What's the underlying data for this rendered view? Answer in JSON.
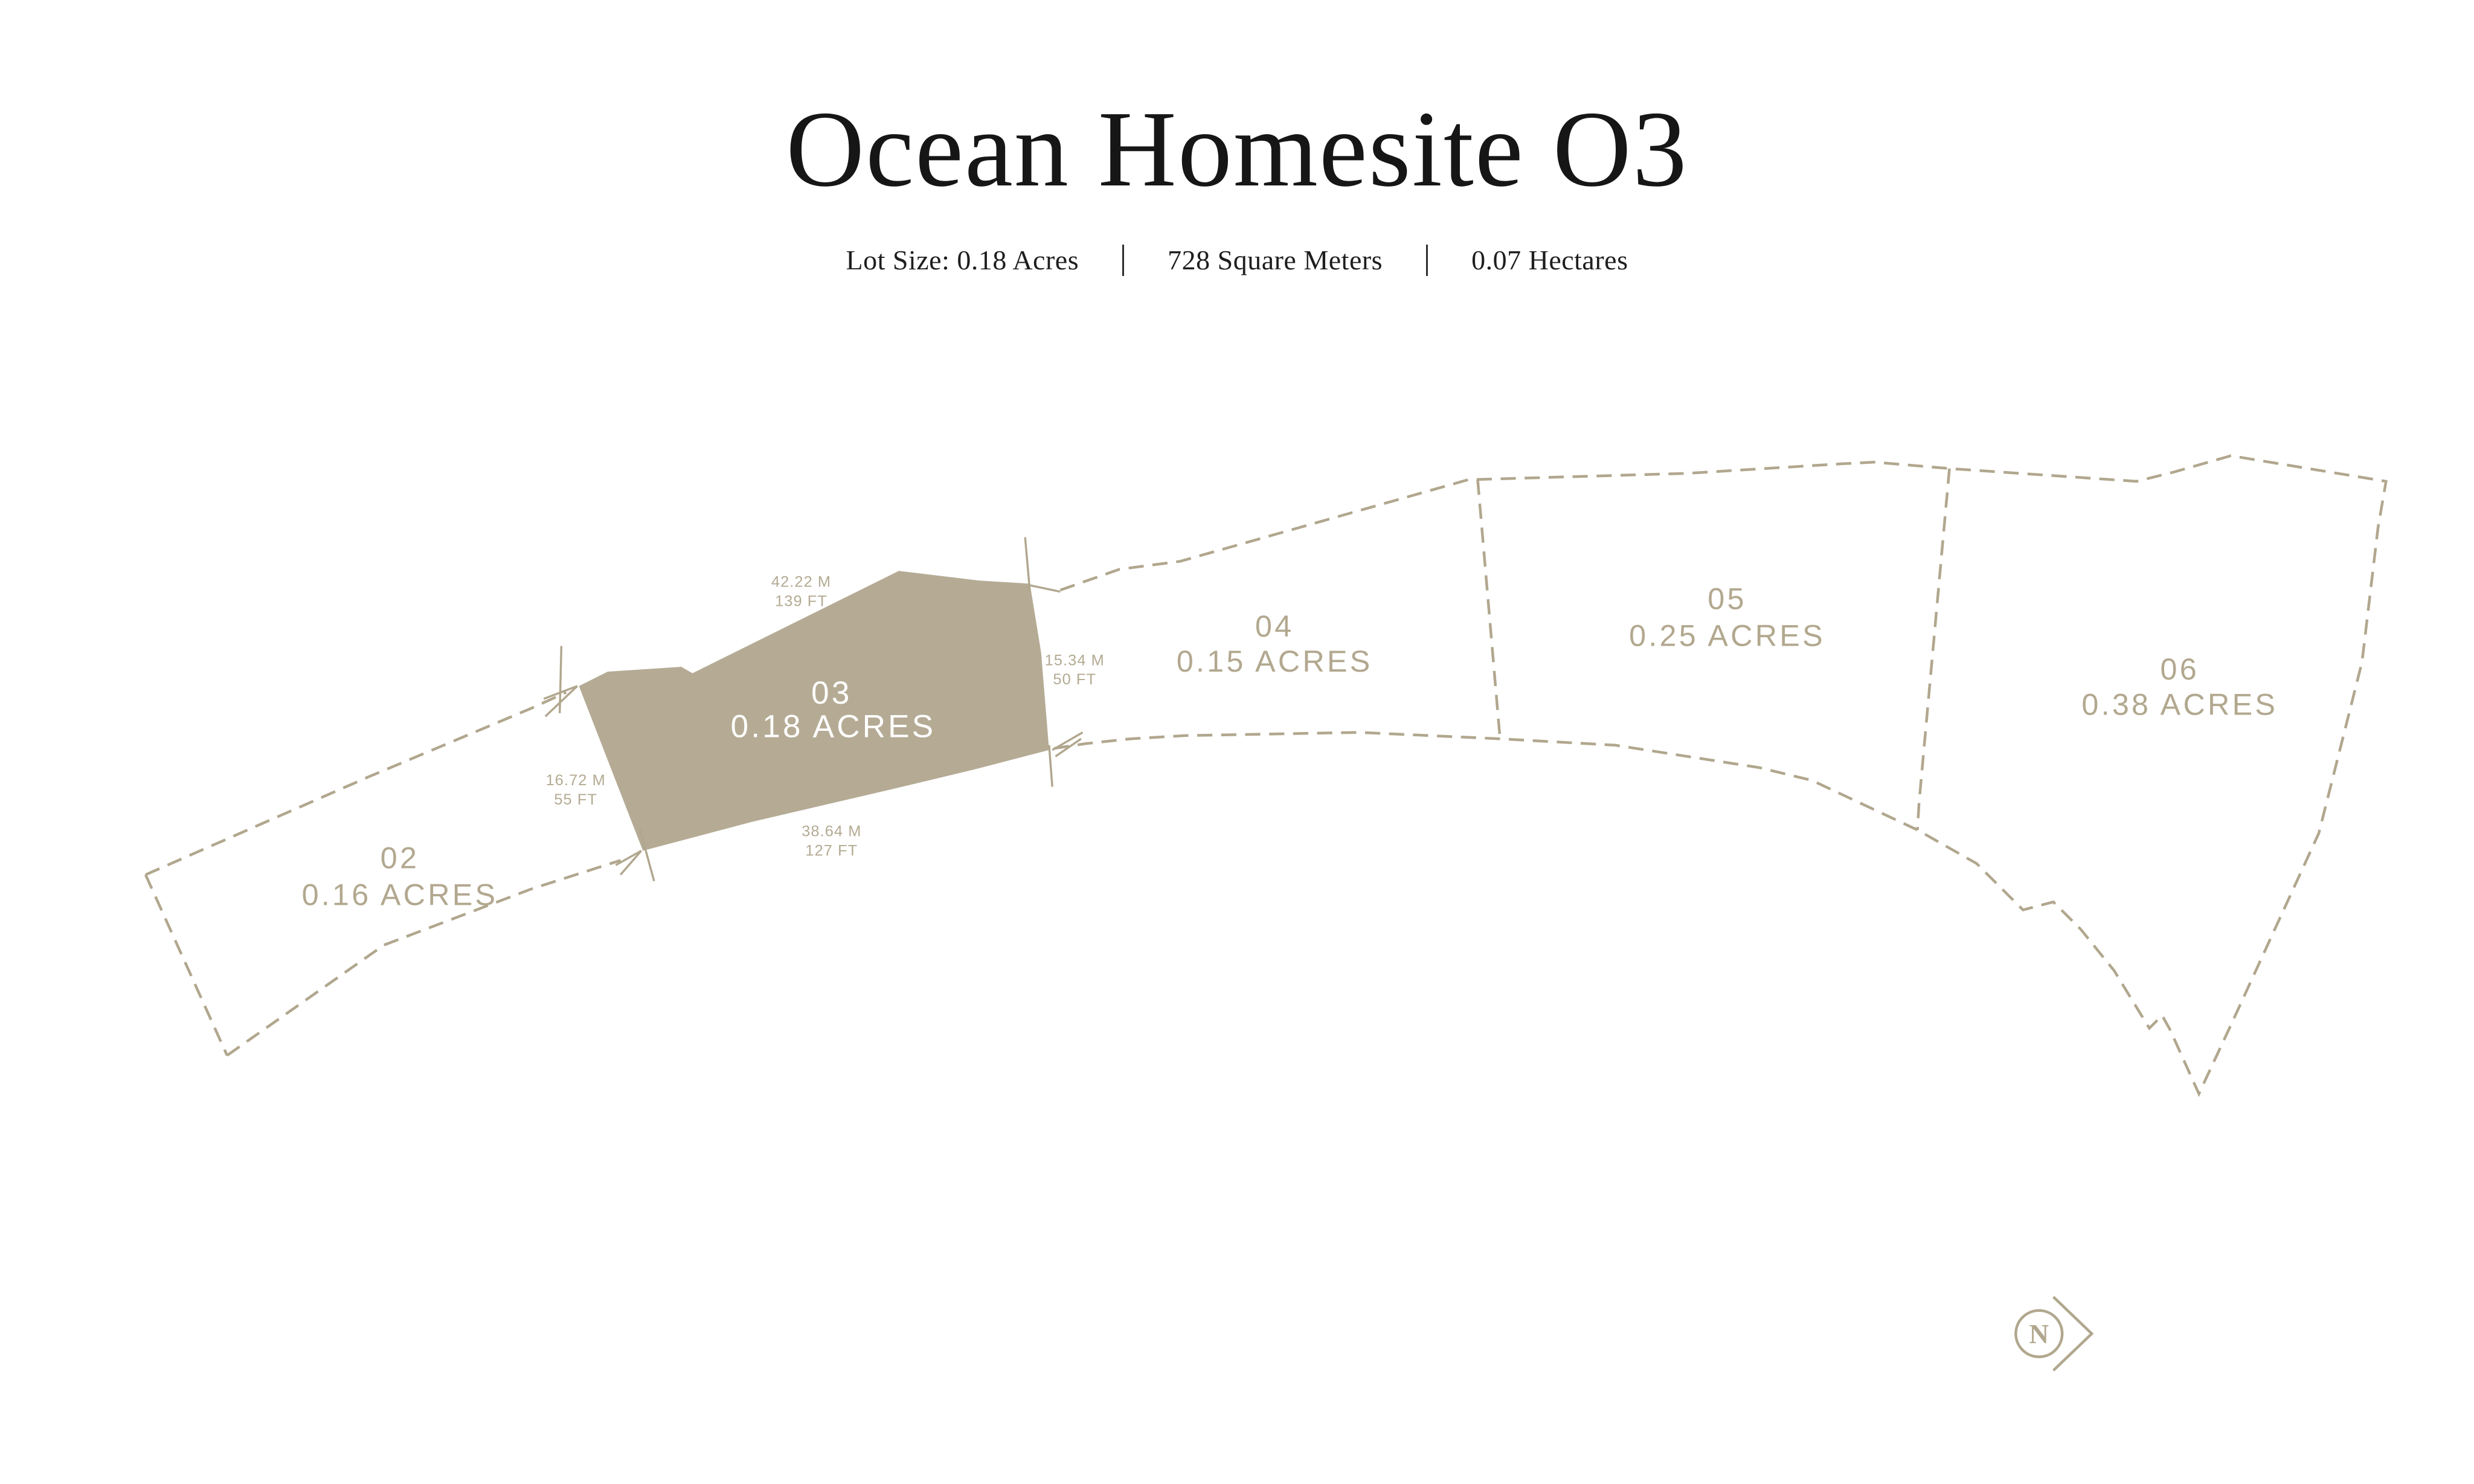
{
  "header": {
    "title": "Ocean Homesite O3",
    "stats": [
      {
        "label": "Lot Size: 0.18 Acres"
      },
      {
        "label": "728 Square Meters"
      },
      {
        "label": "0.07 Hectares"
      }
    ]
  },
  "plan": {
    "lots": [
      {
        "number": "02",
        "area": "0.16 ACRES",
        "highlighted": false
      },
      {
        "number": "03",
        "area": "0.18 ACRES",
        "highlighted": true
      },
      {
        "number": "04",
        "area": "0.15 ACRES",
        "highlighted": false
      },
      {
        "number": "05",
        "area": "0.25 ACRES",
        "highlighted": false
      },
      {
        "number": "06",
        "area": "0.38 ACRES",
        "highlighted": false
      }
    ],
    "measurements": [
      {
        "edge": "top",
        "metric": "42.22 M",
        "imperial": "139 FT"
      },
      {
        "edge": "right",
        "metric": "15.34 M",
        "imperial": "50 FT"
      },
      {
        "edge": "left",
        "metric": "16.72 M",
        "imperial": "55 FT"
      },
      {
        "edge": "bottom",
        "metric": "38.64 M",
        "imperial": "127 FT"
      }
    ],
    "north": {
      "letter": "N"
    }
  },
  "colors": {
    "tan_line": "#b1a78e",
    "lot_fill": "#b5ab95",
    "label_text": "#b2a88f",
    "highlight_label_text": "#ffffff",
    "ink": "#161616",
    "background": "#ffffff"
  }
}
